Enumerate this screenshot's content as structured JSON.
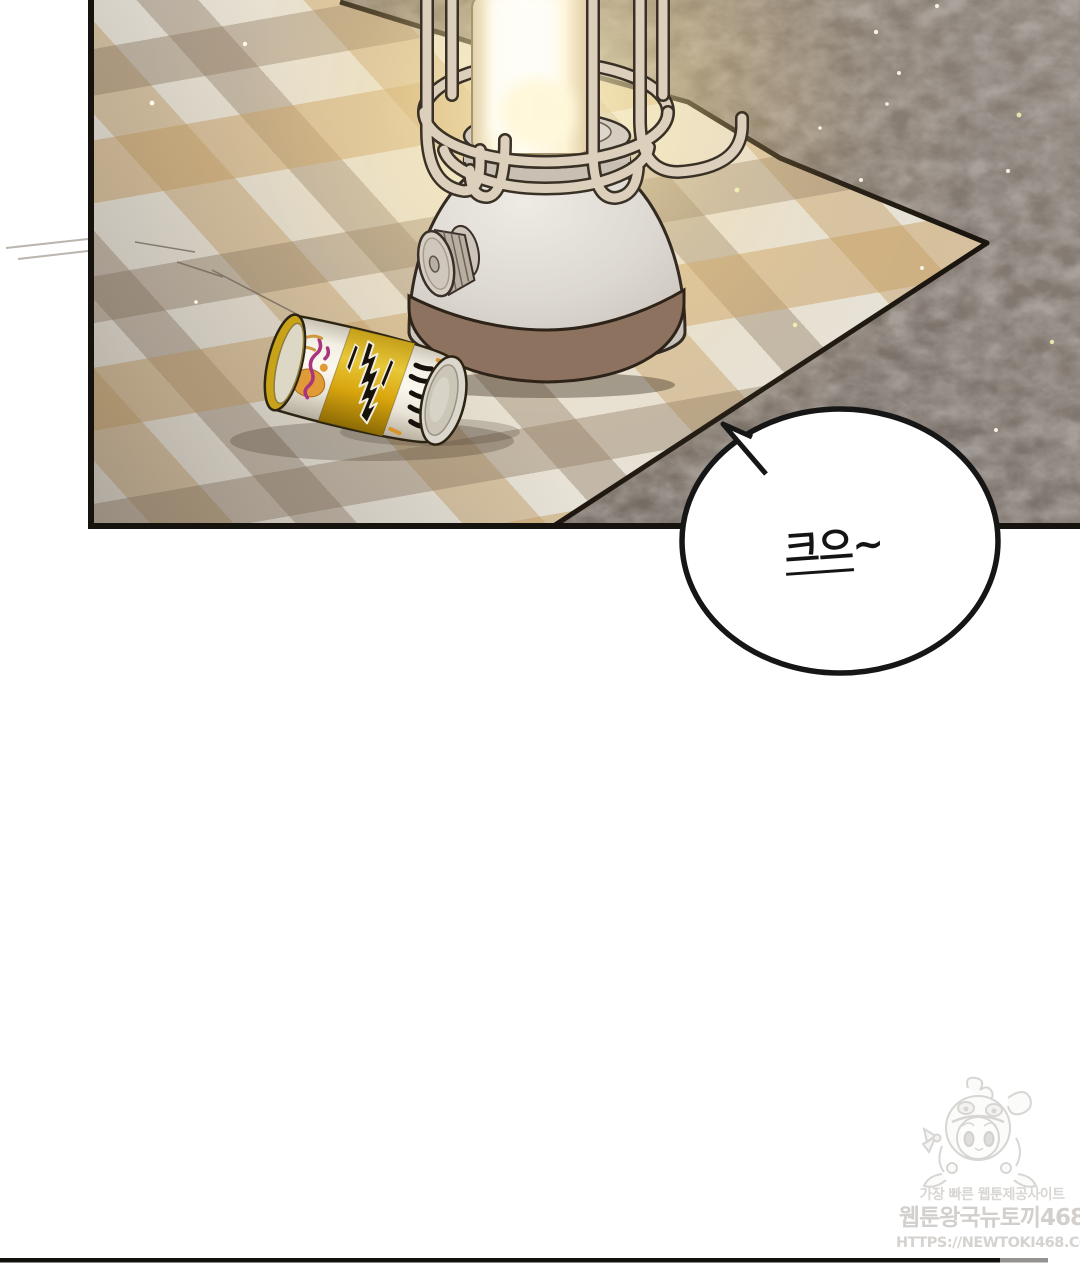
{
  "bubble": {
    "text": "크으~",
    "text_emphasized": "크으",
    "text_suffix": "~"
  },
  "watermark": {
    "tagline": "가장 빠른 웹툰제공사이트",
    "site_name": "웹툰왕국뉴토끼468",
    "site_url": "HTTPS://NEWTOKI468.COM"
  },
  "scene": {
    "objects": [
      "camping-lantern",
      "beer-can",
      "plaid-picnic-blanket",
      "dark-ground"
    ],
    "colors": {
      "panel_border": "#16120d",
      "ground_base": "#7a716a",
      "blanket_base": "#e6e2d8",
      "blanket_tan": "#c69e62",
      "blanket_brown": "#8f7b64",
      "lantern_glow": "#ffeeb2",
      "lantern_body": "#dad5cf",
      "lantern_base_band": "#8d7260",
      "can_band_gold": "#d9a60e",
      "can_accent_magenta": "#aa3480",
      "can_accent_orange": "#e09a36",
      "bubble_fill": "#ffffff",
      "bubble_stroke": "#161616",
      "watermark_text": "#d5d2cf"
    }
  }
}
